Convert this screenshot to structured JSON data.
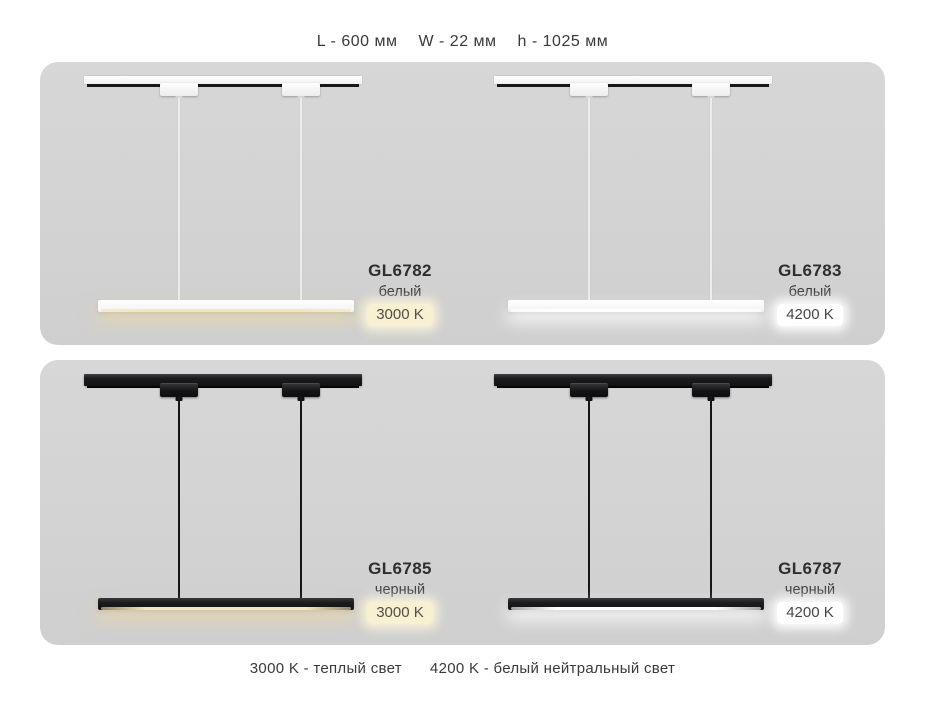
{
  "page": {
    "header": {
      "dims": [
        "L - 600 мм",
        "W - 22 мм",
        "h - 1025 мм"
      ]
    },
    "footer": {
      "legend_warm": "3000 K - теплый свет",
      "legend_neutral": "4200 K - белый нейтральный свет"
    }
  },
  "products": [
    {
      "code": "GL6782",
      "finish": "белый",
      "temperature": "3000 K",
      "fixture_color": "white",
      "light_type": "warm"
    },
    {
      "code": "GL6783",
      "finish": "белый",
      "temperature": "4200 K",
      "fixture_color": "white",
      "light_type": "neutral"
    },
    {
      "code": "GL6785",
      "finish": "черный",
      "temperature": "3000 K",
      "fixture_color": "black",
      "light_type": "warm"
    },
    {
      "code": "GL6787",
      "finish": "черный",
      "temperature": "4200 K",
      "fixture_color": "black",
      "light_type": "neutral"
    }
  ],
  "colors": {
    "panel_bg": "#d3d3d3",
    "warm_badge_bg": "#f7f0d3",
    "neutral_badge_bg": "#ffffff",
    "warm_glow": "#f2da92",
    "text": "#3a3a3a",
    "fixture_white": "#ffffff",
    "fixture_black": "#1b1b1d"
  }
}
